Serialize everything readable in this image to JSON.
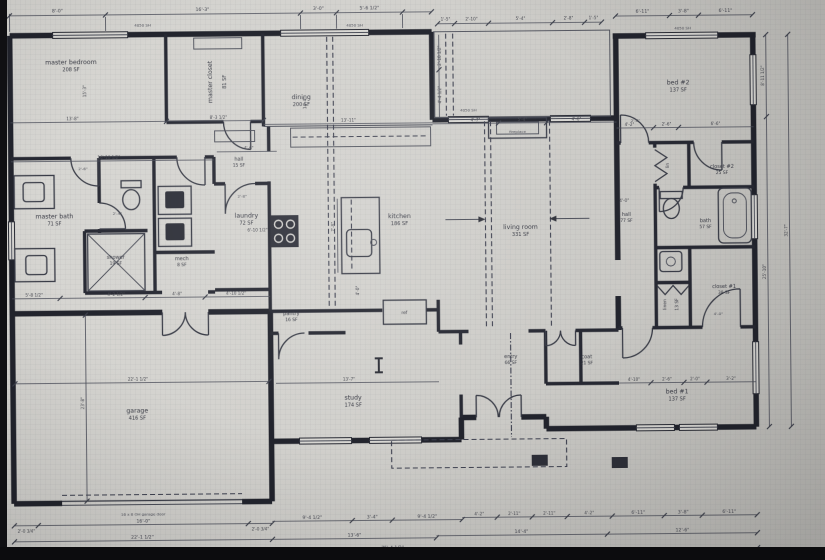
{
  "document": {
    "type": "residential floor plan"
  },
  "rooms": {
    "master_bedroom": {
      "name": "master bedroom",
      "area": "208 SF"
    },
    "master_closet": {
      "name": "master closet",
      "area": "81 SF"
    },
    "dining": {
      "name": "dining",
      "area": "200 SF"
    },
    "hall_main": {
      "name": "hall",
      "area": "15 SF"
    },
    "laundry": {
      "name": "laundry",
      "area": "72 SF"
    },
    "master_bath": {
      "name": "master bath",
      "area": "71 SF"
    },
    "shower": {
      "name": "shower",
      "area": "19 SF"
    },
    "mech": {
      "name": "mech",
      "area": "8 SF"
    },
    "kitchen": {
      "name": "kitchen",
      "area": "186 SF"
    },
    "living_room": {
      "name": "living room",
      "area": "331 SF"
    },
    "pantry": {
      "name": "pantry",
      "area": "16 SF"
    },
    "garage": {
      "name": "garage",
      "area": "416 SF"
    },
    "study": {
      "name": "study",
      "area": "174 SF"
    },
    "entry": {
      "name": "entry",
      "area": "66 SF"
    },
    "coat": {
      "name": "coat",
      "area": "21 SF"
    },
    "bed2": {
      "name": "bed #2",
      "area": "137 SF"
    },
    "closet2": {
      "name": "closet #2",
      "area": "25 SF"
    },
    "lin_small": {
      "name": "lin",
      "area": ""
    },
    "hall_bed": {
      "name": "hall",
      "area": "77 SF"
    },
    "bath2": {
      "name": "bath",
      "area": "57 SF"
    },
    "closet1": {
      "name": "closet #1",
      "area": "38 SF"
    },
    "linen": {
      "name": "linen",
      "area": "13 SF"
    },
    "bed1": {
      "name": "bed #1",
      "area": "137 SF"
    }
  },
  "fixtures": {
    "ref": "ref",
    "fireplace": "fireplace"
  },
  "notes": {
    "garage_door": "16 x 8 OH garage door"
  },
  "dims": {
    "top": [
      "8'-0\"",
      "16'-3\"",
      "3'-0\"",
      "5'-6 1/2\"",
      "1'-5\"",
      "2'-10\"",
      "5'-4\"",
      "2'-8\"",
      "1'-5\"",
      "6'-11\"",
      "3'-8\"",
      "6'-11\""
    ],
    "bottom": [
      "2'-0 3/4\"",
      "16'-0\"",
      "2'-0 3/4\"",
      "9'-4 1/2\"",
      "3'-4\"",
      "9'-4 1/2\"",
      "4'-2\"",
      "2'-11\"",
      "2'-11\"",
      "4'-2\"",
      "6'-11\"",
      "3'-8\"",
      "6'-11\"",
      "22'-1 1/2\"",
      "13'-6\"",
      "14'-4\"",
      "12'-6\"",
      "75'-4 1/2\""
    ],
    "right": [
      "8'-11 1/2\"",
      "25'-10\"",
      "32'-7\""
    ],
    "left": [
      "23'-8\""
    ],
    "inner": [
      "13'-8\"",
      "8'-3 1/2\"",
      "16'-10 1/2\"",
      "4'-6\"",
      "13'-11\"",
      "15'-3\"",
      "14'-4\"",
      "7'-8\"",
      "4'-0\"",
      "6'-10 1/2\"",
      "5'-8 1/2\"",
      "4'-2 1/2\"",
      "4'-8\"",
      "4'-10 1/2\"",
      "13'-7\"",
      "4'-7\"",
      "5'-4\"",
      "4'-6\"",
      "4'-10\"",
      "2'-6\"",
      "2'-0\"",
      "3'-2\"",
      "4'-2\"",
      "2'-6\"",
      "6'-6\"",
      "4'-0\"",
      "2'-10 1/2\"",
      "4'-4 1/2\"",
      "22'-1 1/2\"",
      "2'-6\"",
      "2'-8\"",
      "2'-4\"",
      "2'-8\"",
      "4'-0\""
    ],
    "window_tag": "4050 SH"
  }
}
